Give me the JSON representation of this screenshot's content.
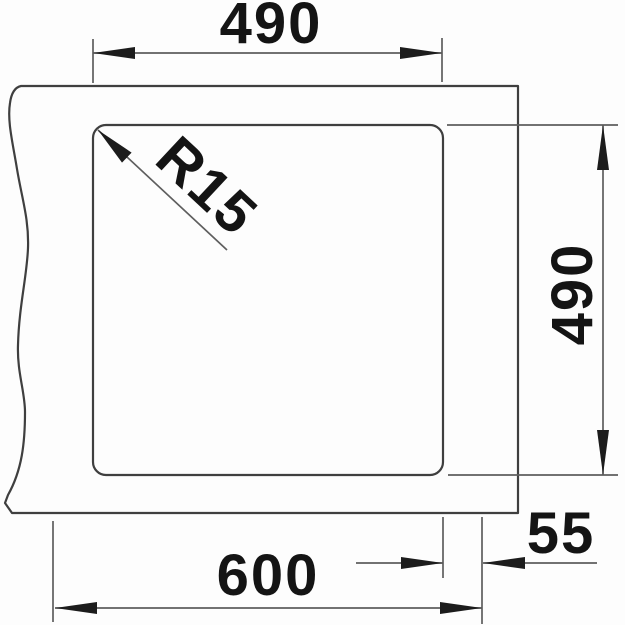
{
  "drawing": {
    "kind": "technical-dimension-drawing",
    "labels": {
      "top_width": "490",
      "side_depth": "490",
      "corner_radius": "R15",
      "edge_offset": "55",
      "overall_width": "600"
    },
    "colors": {
      "background": "#fdfdfd",
      "outline": "#3f3f3f",
      "dimension_line": "#5e5e5e",
      "text": "#141414"
    }
  }
}
